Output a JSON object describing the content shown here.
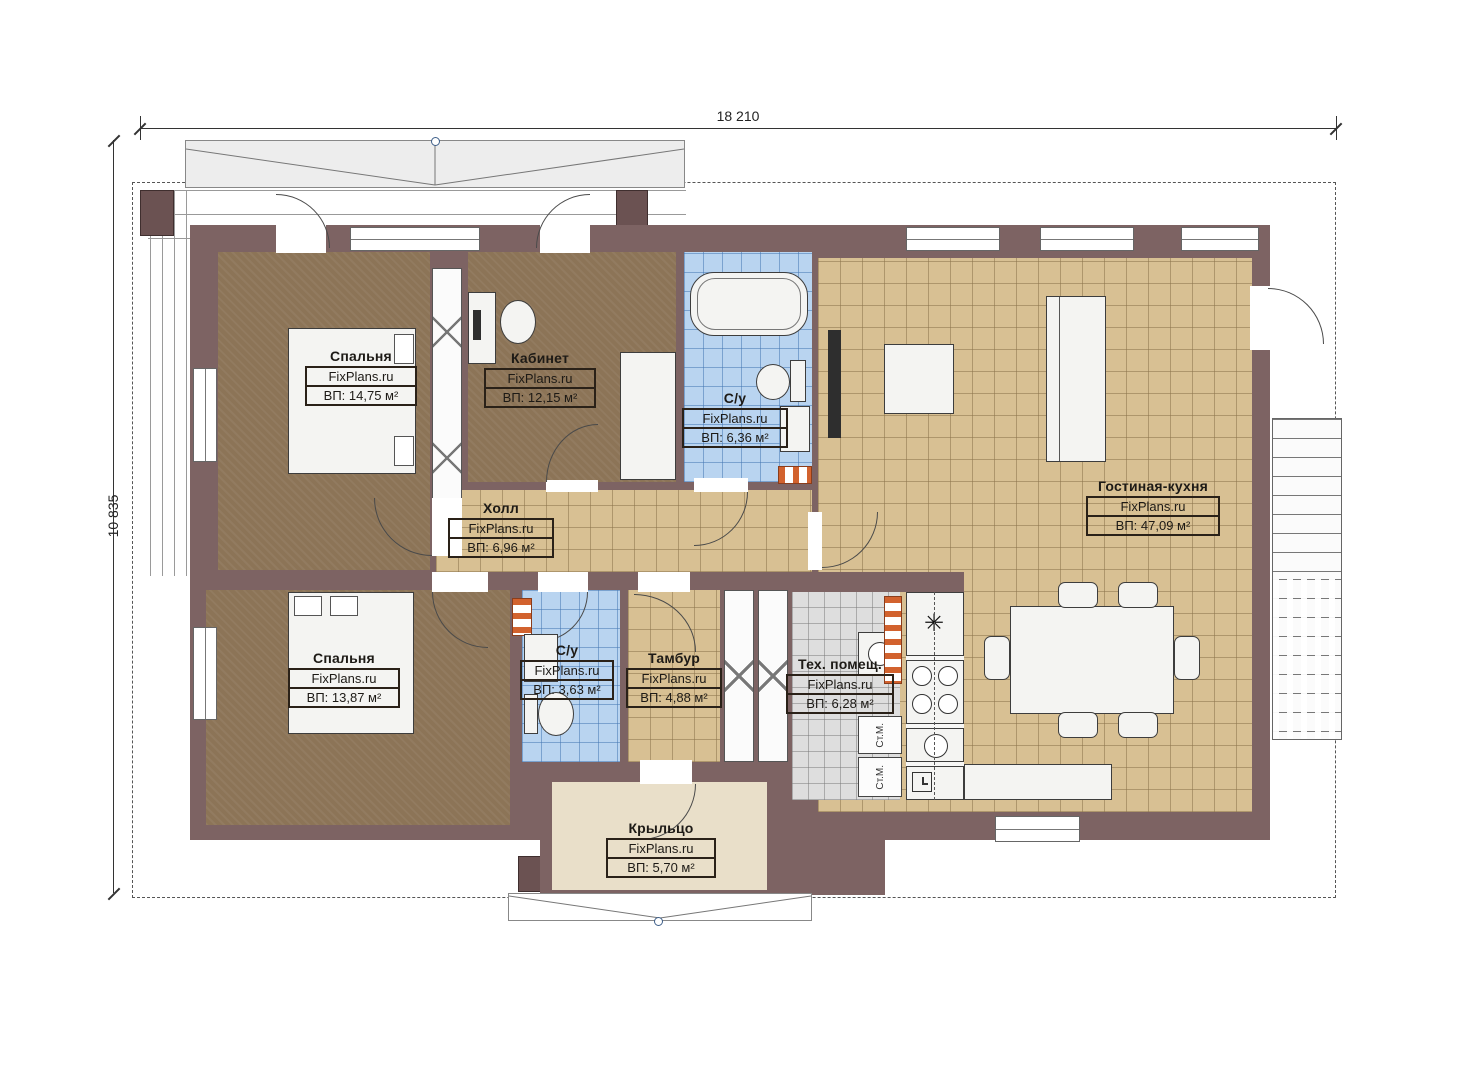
{
  "dimensions": {
    "width_label": "18 210",
    "height_label": "10 835"
  },
  "rooms": [
    {
      "name": "Спальня",
      "watermark": "FixPlans.ru",
      "area": "ВП: 14,75 м²"
    },
    {
      "name": "Кабинет",
      "watermark": "FixPlans.ru",
      "area": "ВП: 12,15 м²"
    },
    {
      "name": "С/у",
      "watermark": "FixPlans.ru",
      "area": "ВП: 6,36 м²"
    },
    {
      "name": "Гостиная-кухня",
      "watermark": "FixPlans.ru",
      "area": "ВП: 47,09 м²"
    },
    {
      "name": "Холл",
      "watermark": "FixPlans.ru",
      "area": "ВП: 6,96 м²"
    },
    {
      "name": "Спальня",
      "watermark": "FixPlans.ru",
      "area": "ВП: 13,87 м²"
    },
    {
      "name": "С/у",
      "watermark": "FixPlans.ru",
      "area": "ВП: 3,63 м²"
    },
    {
      "name": "Тамбур",
      "watermark": "FixPlans.ru",
      "area": "ВП: 4,88 м²"
    },
    {
      "name": "Тех. помещ.",
      "watermark": "FixPlans.ru",
      "area": "ВП: 6,28 м²"
    },
    {
      "name": "Крыльцо",
      "watermark": "FixPlans.ru",
      "area": "ВП: 5,70 м²"
    }
  ],
  "appliances": {
    "washing_machine_1": "Ст.М.",
    "washing_machine_2": "Ст.М."
  },
  "icons": {
    "freezer": "✳"
  },
  "colors": {
    "wall": "#7d6363",
    "bedroom_floor": "#8c7457",
    "tile_tan": "#d8c093",
    "tile_blue": "#b9d4f0",
    "tile_gray": "#dedede",
    "porch_floor": "#e9dfc9",
    "accent_orange": "#d2622e"
  }
}
